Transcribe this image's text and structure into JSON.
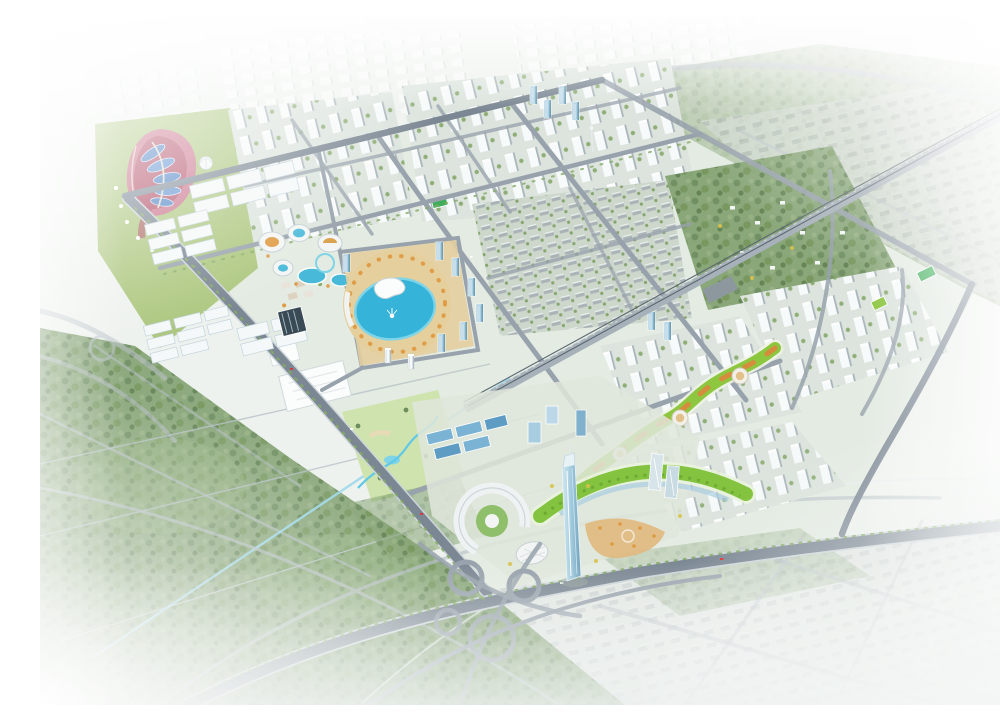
{
  "scene": {
    "type": "architectural aerial rendering",
    "description": "Bird's-eye perspective rendering of a planned urban district: a diamond-shaped new town with a flower theme park and logistics warehouses on the west, a circular lagoon resort plaza in the center, dense white residential tower blocks to the north and east, a railway corridor cutting diagonally, a winding green ribbon park, a CBD with one landmark glass skyscraper and a green arc-shaped building, a cloverleaf highway interchange at the south, and hazy white city fading out at all edges.",
    "visible_text": []
  },
  "regions": {
    "flower_park": {
      "label": "flower theme park with petal canopies"
    },
    "dome_pavilion": {
      "label": "round dome pavilion"
    },
    "warehouses": {
      "label": "logistics warehouse district"
    },
    "campus": {
      "label": "low-rise campus buildings"
    },
    "solar_building": {
      "label": "dark solar-roof building"
    },
    "resort": {
      "label": "water-park resort with oval buildings and pools"
    },
    "lagoon_plaza": {
      "label": "circular lagoon plaza with fountain"
    },
    "plaza_towers": {
      "label": "glass office towers around lagoon"
    },
    "north_residential": {
      "label": "northern residential tower blocks"
    },
    "glass_cluster": {
      "label": "blue glass high-rise cluster"
    },
    "villas": {
      "label": "low-rise villa district"
    },
    "ne_forest_park": {
      "label": "northeast wooded park with villas"
    },
    "railway": {
      "label": "railway corridor"
    },
    "east_residential": {
      "label": "eastern residential superblocks"
    },
    "greenway": {
      "label": "winding greenway ribbon park with terraces"
    },
    "cbd": {
      "label": "central business district"
    },
    "landmark_tower": {
      "label": "landmark glass skyscraper"
    },
    "green_arc": {
      "label": "green arc-roofed megastructure"
    },
    "crescent_building": {
      "label": "crescent-shaped office building"
    },
    "exhibition_hall": {
      "label": "white exhibition hall"
    },
    "landscape_park": {
      "label": "landscape park with stream and ponds"
    },
    "interchange": {
      "label": "cloverleaf highway interchange"
    },
    "sw_forest": {
      "label": "southwest forest belt"
    },
    "canal": {
      "label": "drainage canal"
    },
    "power_lines": {
      "label": "transmission lines across forest"
    },
    "gray_city_se": {
      "label": "existing low-rise city fading southeast"
    },
    "gray_city_ne": {
      "label": "existing city fading northeast"
    },
    "distant_city": {
      "label": "distant hazy city blocks"
    },
    "sports_pitches": {
      "label": "green sports pitches"
    },
    "haze": {
      "label": "white atmospheric haze vignette"
    }
  },
  "palette": {
    "base": "#eef2ee",
    "haze": "#ffffff",
    "district_ground": "#e0e8de",
    "forest": "#85a374",
    "forest_dark": "#5f804f",
    "forest_light": "#9db98a",
    "lawn": "#adc77f",
    "flower_pink": "#c9718a",
    "flower_red": "#ae4a60",
    "petal_blue": "#4d82c4",
    "cream": "#ece5d2",
    "road_major": "#7b8793",
    "road_minor": "#98a2ac",
    "road_faint": "#b9c1c9",
    "verge": "#85aa66",
    "rail_band": "#a7b1b9",
    "rail_dark": "#5b6770",
    "water": "#35b3d9",
    "water_light": "#7fd4e8",
    "plaza_tan": "#e5cf9d",
    "orange_tree": "#df9a42",
    "bldg_white": "#f5f8f8",
    "bldg_shade": "#b9c4c9",
    "glass_blue": "#a9cde0",
    "glass_deep": "#7fb0cc",
    "roof_blue": "#7ab3d4",
    "warehouse_edge": "#c3d4de",
    "arc_green": "#84c340",
    "ribbon_green": "#8dc63f",
    "terrace_orange": "#d98a3d",
    "gray_roof": "#b1bab9",
    "gray_base": "#d6dcd7",
    "pitch": "#3fae5a",
    "yellow_tree": "#d9c24a",
    "solar_dark": "#3a4a55"
  }
}
